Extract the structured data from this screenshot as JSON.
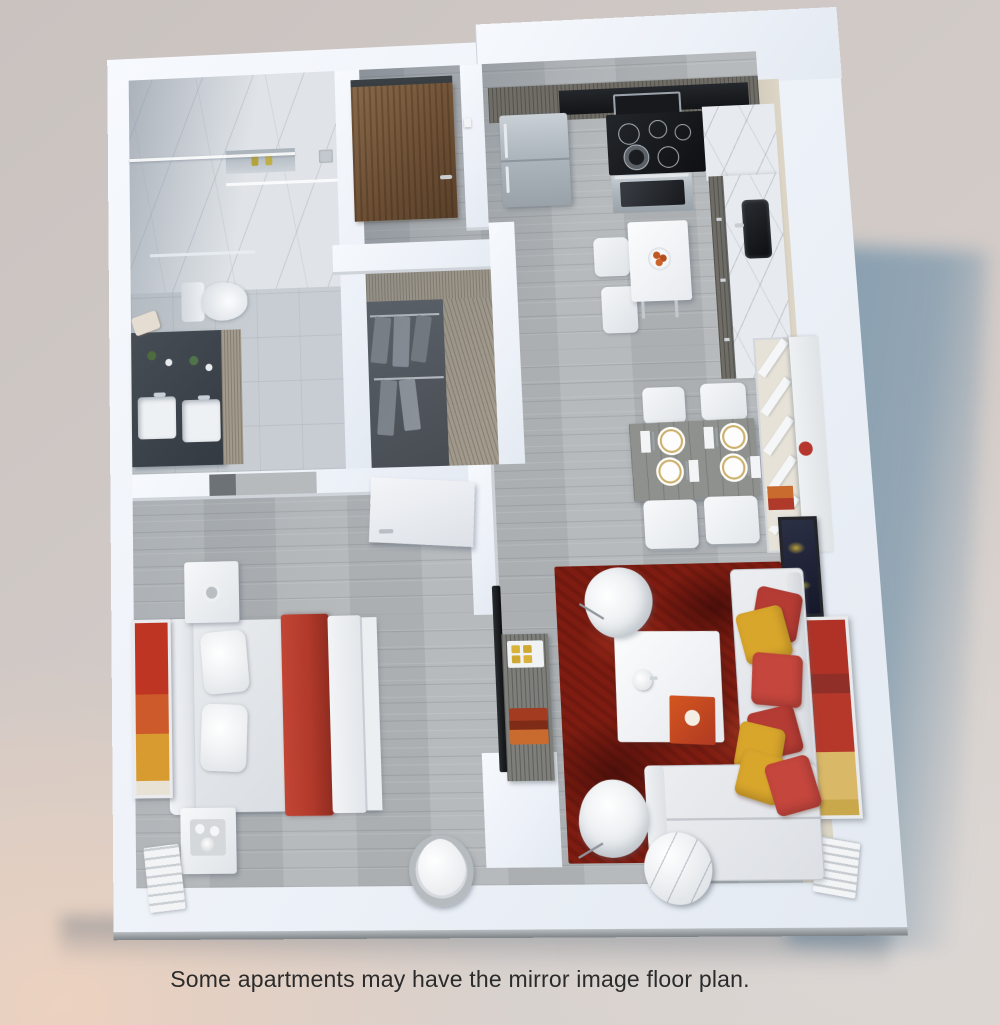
{
  "caption": {
    "text": "Some apartments may have the mirror image floor plan."
  },
  "scene": {
    "type": "3d-isometric-floor-plan-render",
    "unit": "one-bedroom apartment",
    "rooms": [
      {
        "name": "bathroom",
        "items": [
          "marble walk-in shower",
          "glass shower partition",
          "shower niche with bottles",
          "toilet",
          "dark double-sink vanity",
          "tile floor"
        ]
      },
      {
        "name": "entry-hall",
        "items": [
          "wood entry door",
          "light switch",
          "plank floor"
        ]
      },
      {
        "name": "walk-in-closet",
        "items": [
          "wood shelving",
          "hanging clothes on two rods"
        ]
      },
      {
        "name": "kitchen",
        "items": [
          "refrigerator",
          "microwave",
          "cooktop with 5 burners",
          "oven",
          "black sink",
          "marble counters",
          "bar table with fruit bowl",
          "two bar chairs"
        ]
      },
      {
        "name": "dining-area",
        "items": [
          "wood dining table",
          "four chairs",
          "four gold-rim place settings with cutlery and napkins"
        ]
      },
      {
        "name": "living-room",
        "items": [
          "red area rug",
          "sectional sofa",
          "red and yellow pillows",
          "white coffee table with book and kettle",
          "two shell armchairs",
          "round marble side table",
          "media console with tv",
          "white shelf unit",
          "two wall artworks",
          "radiator"
        ]
      },
      {
        "name": "bedroom",
        "items": [
          "double bed with red throw",
          "headboard",
          "two nightstands",
          "abstract wall art",
          "slatted bench",
          "round lounge chair",
          "white door"
        ]
      }
    ]
  },
  "palette": {
    "background": "#d0c9c6",
    "background_warm": "#ecd2c0",
    "shadow_blue": "#7e99ad",
    "wall_white": "#f1f4f8",
    "inner_wall_cream": "#d9d2c2",
    "floor_wood": "#b2b6b9",
    "tile": "#c7cdd2",
    "marble": "#e0e4e8",
    "rug_red": "#7e1c11",
    "accent_red": "#c4463d",
    "accent_yellow": "#d9a62c",
    "bed_throw": "#b23a2b",
    "door_wood": "#7a5838",
    "cabinet_wood": "#6f6d66",
    "vanity_dark": "#3f454c"
  }
}
